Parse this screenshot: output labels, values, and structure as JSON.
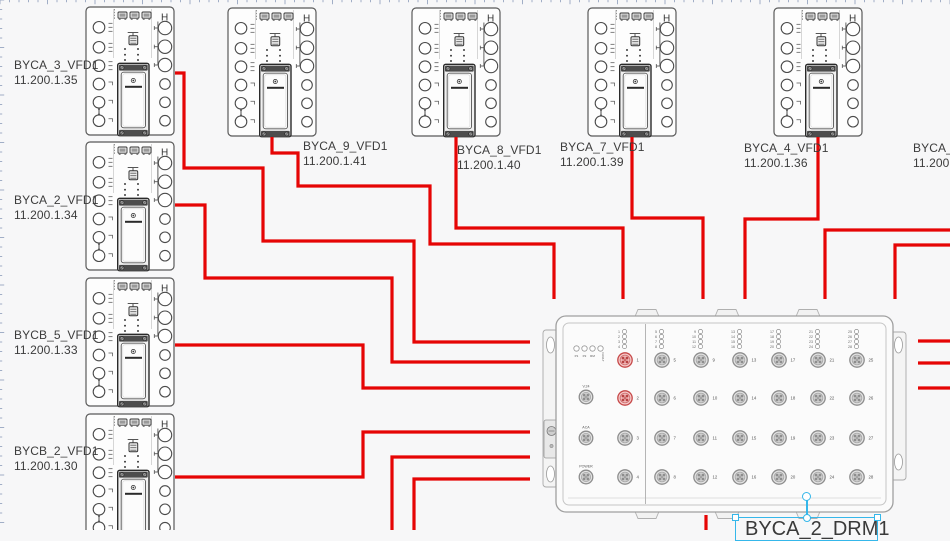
{
  "app": {
    "background": "#f7f7f8",
    "wire_color": "#e60505",
    "selection_color": "#35b7ea",
    "label_color": "#3c3c3c"
  },
  "vfd_symbol": {
    "handle_glyph": "H"
  },
  "vfd_units": [
    {
      "id": "BYCA_3",
      "x": 85,
      "y": 6,
      "label": "BYCA_3_VFD1",
      "ip": "11.200.1.35",
      "label_x": 14,
      "label_y": 58
    },
    {
      "id": "BYCA_2",
      "x": 85,
      "y": 141,
      "label": "BYCA_2_VFD1",
      "ip": "11.200.1.34",
      "label_x": 14,
      "label_y": 193
    },
    {
      "id": "BYCB_5",
      "x": 85,
      "y": 277,
      "label": "BYCB_5_VFD1",
      "ip": "11.200.1.33",
      "label_x": 14,
      "label_y": 328
    },
    {
      "id": "BYCB_2",
      "x": 85,
      "y": 413,
      "label": "BYCB_2_VFD1",
      "ip": "11.200.1.30",
      "label_x": 14,
      "label_y": 444
    },
    {
      "id": "BYCA_9",
      "x": 227,
      "y": 7,
      "label": "BYCA_9_VFD1",
      "ip": "11.200.1.41",
      "label_x": 303,
      "label_y": 139
    },
    {
      "id": "BYCA_8",
      "x": 411,
      "y": 7,
      "label": "BYCA_8_VFD1",
      "ip": "11.200.1.40",
      "label_x": 457,
      "label_y": 143
    },
    {
      "id": "BYCA_7",
      "x": 587,
      "y": 7,
      "label": "BYCA_7_VFD1",
      "ip": "11.200.1.39",
      "label_x": 560,
      "label_y": 140
    },
    {
      "id": "BYCA_4",
      "x": 773,
      "y": 7,
      "label": "BYCA_4_VFD1",
      "ip": "11.200.1.36",
      "label_x": 744,
      "label_y": 141
    },
    {
      "id": "BYCA_5",
      "x": 958,
      "y": 7,
      "label": "BYCA_5_",
      "ip": "11.200.1",
      "label_x": 913,
      "label_y": 141
    }
  ],
  "drm_switch": {
    "label": "BYCA_2_DRM1",
    "status_leds": [
      "P1",
      "P2",
      "RM",
      "FAULT"
    ],
    "aux_ports": [
      "V.24",
      "ACA",
      "POWER"
    ],
    "highlighted_ports": [
      1,
      2
    ],
    "port_groups": [
      [
        1,
        2,
        3,
        4
      ],
      [
        5,
        6,
        7,
        8
      ],
      [
        9,
        10,
        11,
        12
      ],
      [
        13,
        14,
        15,
        16
      ],
      [
        17,
        18,
        19,
        20
      ],
      [
        21,
        22,
        23,
        24
      ],
      [
        25,
        26,
        27,
        28
      ]
    ]
  },
  "wires": [
    {
      "points": [
        [
          175,
          73
        ],
        [
          184,
          73
        ],
        [
          184,
          168
        ],
        [
          263,
          168
        ],
        [
          263,
          241
        ],
        [
          414,
          241
        ],
        [
          414,
          342
        ],
        [
          530,
          342
        ]
      ]
    },
    {
      "points": [
        [
          272,
          137
        ],
        [
          272,
          153
        ],
        [
          298,
          153
        ],
        [
          298,
          186
        ],
        [
          430,
          186
        ],
        [
          430,
          244
        ],
        [
          554,
          244
        ],
        [
          554,
          299
        ]
      ]
    },
    {
      "points": [
        [
          456,
          137
        ],
        [
          456,
          228
        ],
        [
          623,
          228
        ],
        [
          623,
          299
        ]
      ]
    },
    {
      "points": [
        [
          632,
          137
        ],
        [
          632,
          218
        ],
        [
          703,
          218
        ],
        [
          703,
          299
        ]
      ]
    },
    {
      "points": [
        [
          818,
          137
        ],
        [
          818,
          219
        ],
        [
          745,
          219
        ],
        [
          745,
          299
        ]
      ]
    },
    {
      "points": [
        [
          952,
          230
        ],
        [
          825,
          230
        ],
        [
          825,
          299
        ]
      ]
    },
    {
      "points": [
        [
          952,
          245
        ],
        [
          895,
          245
        ],
        [
          895,
          299
        ]
      ]
    },
    {
      "points": [
        [
          175,
          205
        ],
        [
          205,
          205
        ],
        [
          205,
          278
        ],
        [
          392,
          278
        ],
        [
          392,
          362
        ],
        [
          530,
          362
        ]
      ]
    },
    {
      "points": [
        [
          175,
          345
        ],
        [
          363,
          345
        ],
        [
          363,
          388
        ],
        [
          530,
          388
        ]
      ]
    },
    {
      "points": [
        [
          175,
          477
        ],
        [
          363,
          477
        ],
        [
          363,
          432
        ],
        [
          530,
          432
        ]
      ]
    },
    {
      "points": [
        [
          392,
          531
        ],
        [
          392,
          457
        ],
        [
          530,
          457
        ]
      ]
    },
    {
      "points": [
        [
          414,
          531
        ],
        [
          414,
          479
        ],
        [
          530,
          479
        ]
      ]
    },
    {
      "points": [
        [
          918,
          341
        ],
        [
          952,
          341
        ]
      ]
    },
    {
      "points": [
        [
          918,
          363
        ],
        [
          952,
          363
        ]
      ]
    },
    {
      "points": [
        [
          918,
          388
        ],
        [
          952,
          388
        ]
      ]
    },
    {
      "points": [
        [
          706,
          515
        ],
        [
          706,
          531
        ]
      ]
    }
  ]
}
